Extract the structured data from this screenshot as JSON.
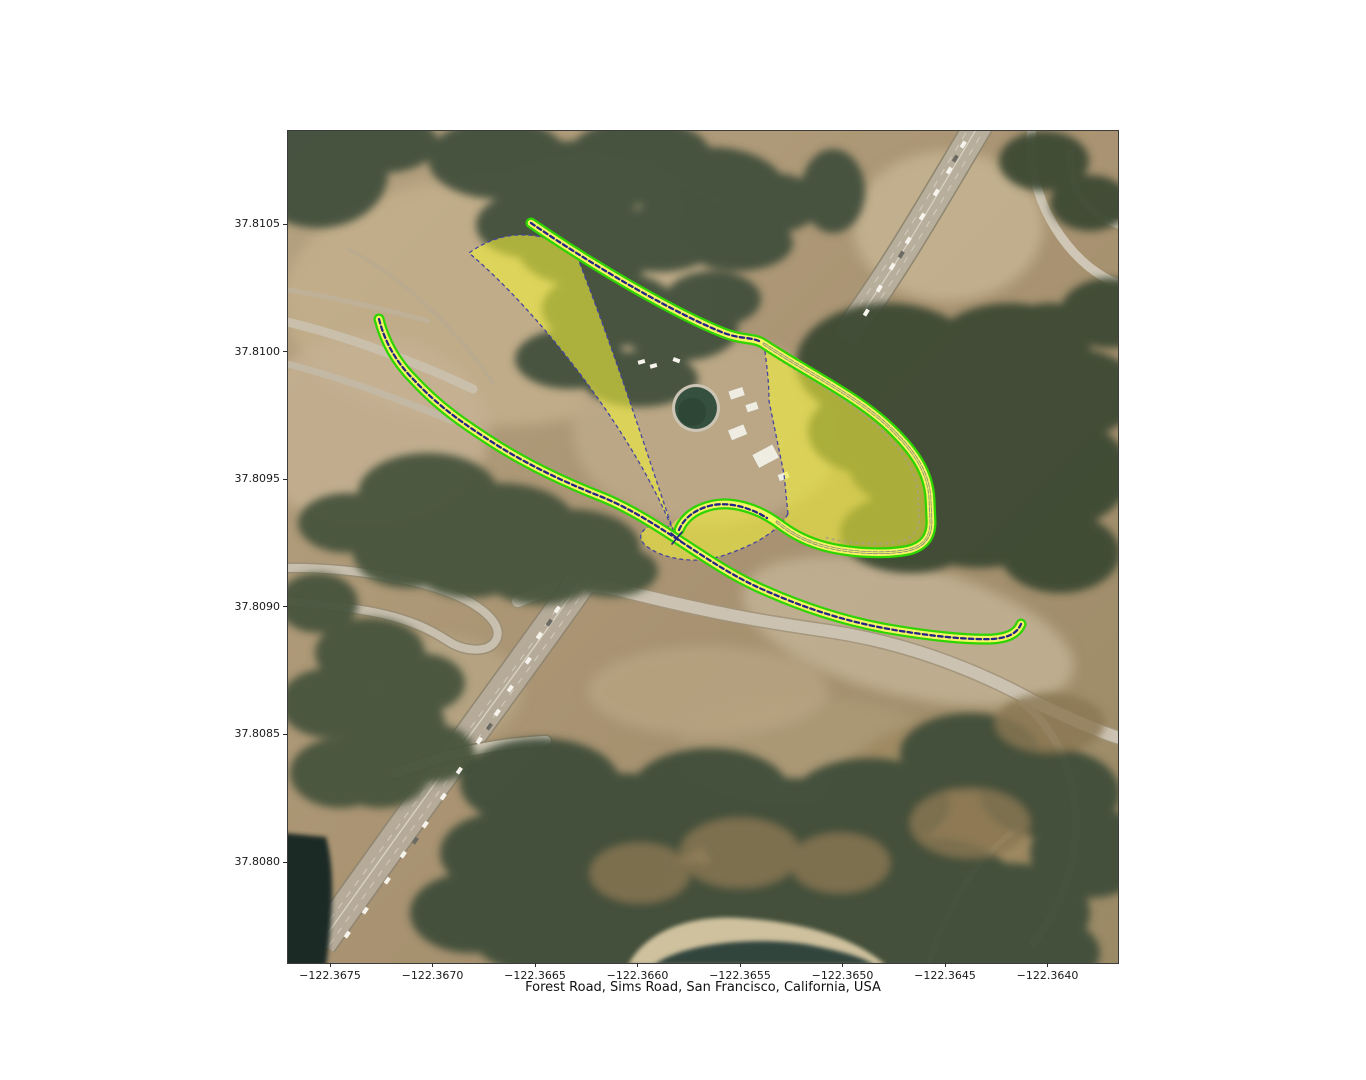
{
  "figure": {
    "xlabel": "Forest Road, Sims Road, San Francisco, California, USA",
    "x_ticks": [
      "−122.3675",
      "−122.3670",
      "−122.3665",
      "−122.3660",
      "−122.3655",
      "−122.3650",
      "−122.3645",
      "−122.3640"
    ],
    "y_ticks": [
      "37.8105",
      "37.8100",
      "37.8095",
      "37.8090",
      "37.8085",
      "37.8080"
    ]
  },
  "overlay": {
    "colors": {
      "route_casing": "#2ed400",
      "route_fill": "#f5f465",
      "centerline_primary": "#232388",
      "centerline_secondary": "#8e8e7c",
      "region_fill": "#f0ef3c",
      "region_border": "#4646a0"
    }
  }
}
